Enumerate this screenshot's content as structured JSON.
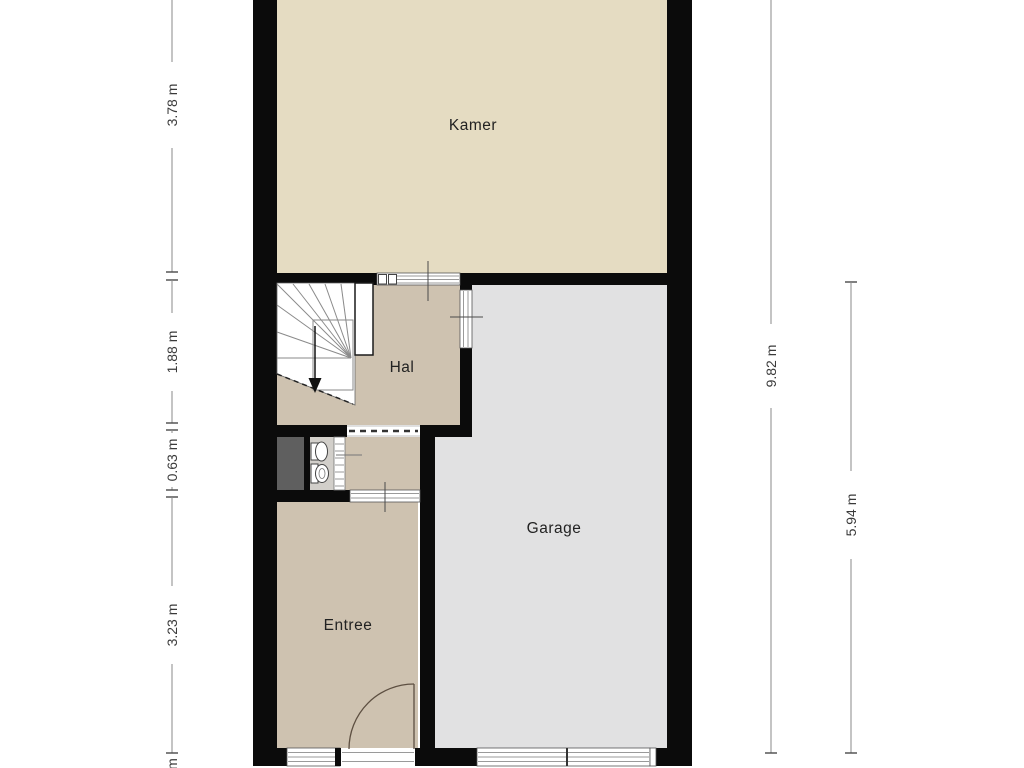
{
  "rooms": {
    "kamer": {
      "label": "Kamer"
    },
    "hal": {
      "label": "Hal"
    },
    "garage": {
      "label": "Garage"
    },
    "entree": {
      "label": "Entree"
    }
  },
  "dimensions": {
    "left": [
      {
        "label": "3.78 m"
      },
      {
        "label": "1.88 m"
      },
      {
        "label": "0.63 m"
      },
      {
        "label": "3.23 m"
      },
      {
        "label": "m"
      }
    ],
    "right": [
      {
        "label": "9.82 m"
      },
      {
        "label": "5.94 m"
      }
    ]
  },
  "icons": {
    "stairs": "winder-staircase-icon",
    "stairs_direction": "arrow-down-icon",
    "toilet": "toilet-icon",
    "sink": "hand-basin-icon",
    "front_door": "door-swing-arc-icon"
  },
  "colors": {
    "wall": "#0b0b0b",
    "room_kamer": "#e5dcc2",
    "room_hal": "#cec2b0",
    "room_garage": "#e1e1e2",
    "room_toilet": "#d2cfca",
    "void": "#5f5f5f",
    "dimension_line": "#8a8a8a",
    "dimension_text": "#3a3a3a",
    "room_text": "#222222"
  }
}
